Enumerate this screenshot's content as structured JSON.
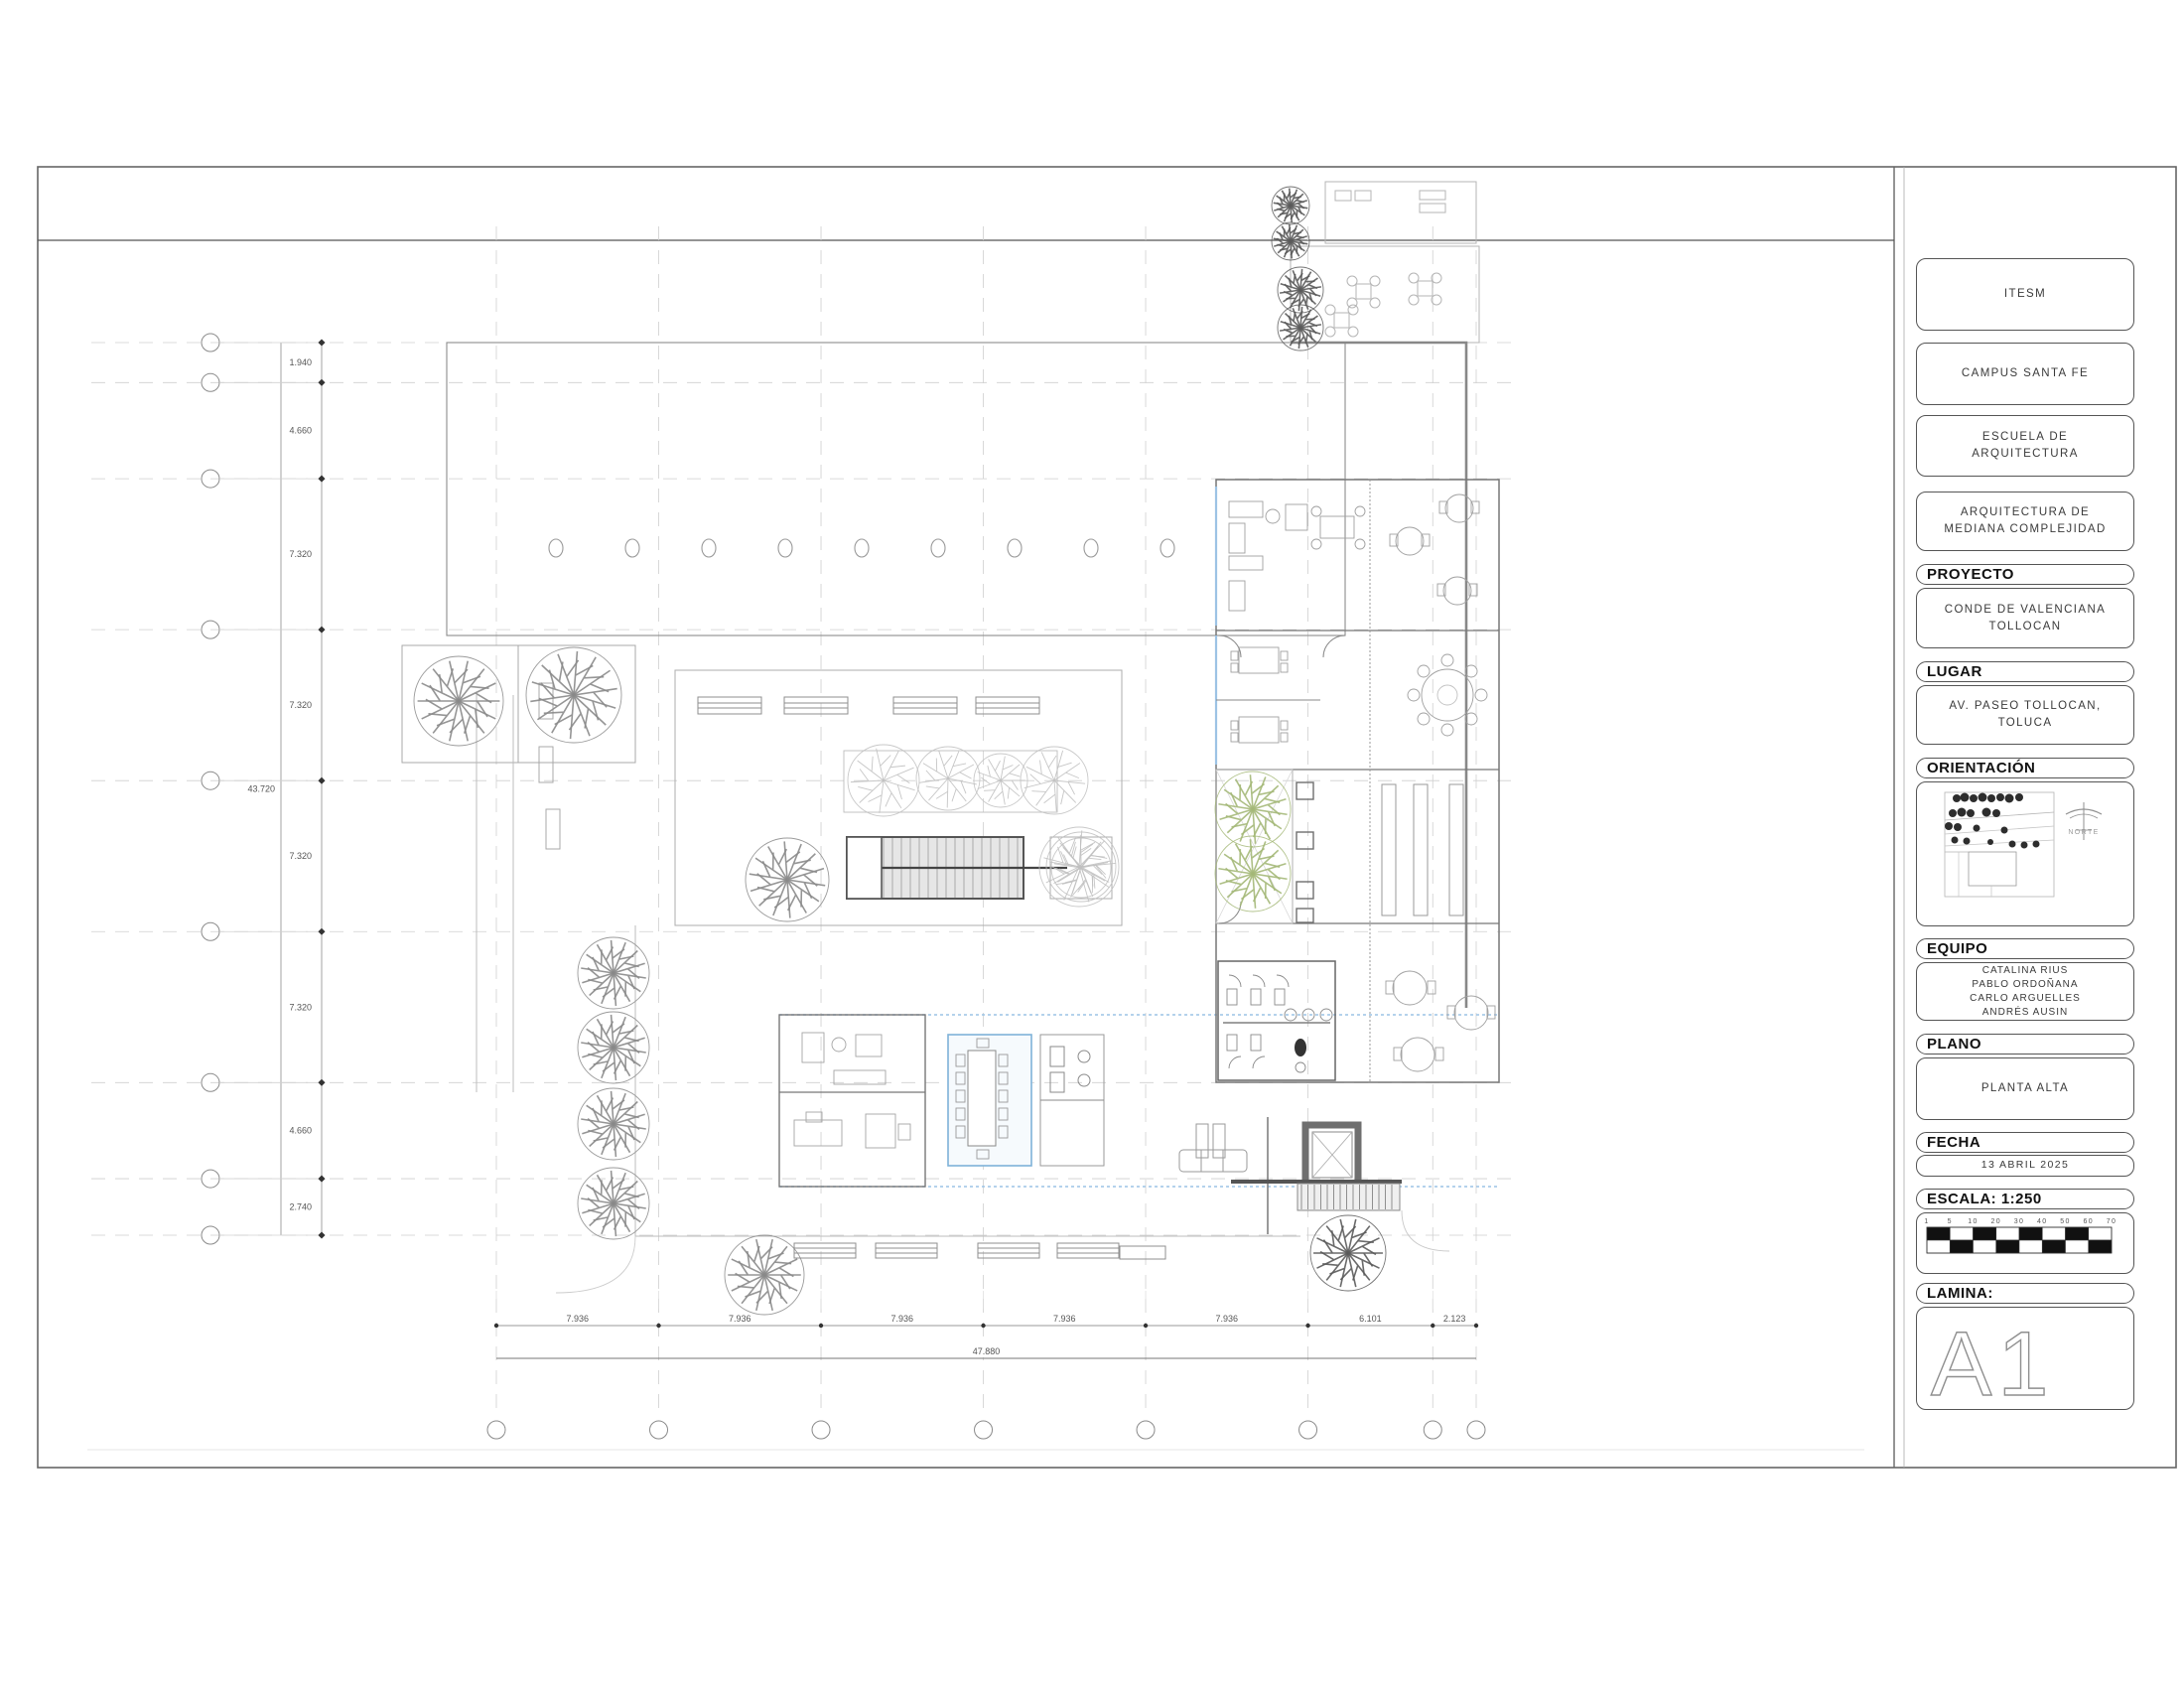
{
  "title_block": {
    "institution": "ITESM",
    "campus": "CAMPUS SANTA FE",
    "school": "ESCUELA DE\nARQUITECTURA",
    "school_l1": "ESCUELA DE",
    "school_l2": "ARQUITECTURA",
    "course_l1": "ARQUITECTURA DE",
    "course_l2": "MEDIANA COMPLEJIDAD",
    "proyecto_label": "PROYECTO",
    "proyecto_l1": "CONDE DE VALENCIANA",
    "proyecto_l2": "TOLLOCAN",
    "lugar_label": "LUGAR",
    "lugar_l1": "AV. PASEO TOLLOCAN,",
    "lugar_l2": "TOLUCA",
    "orientacion_label": "ORIENTACIÓN",
    "norte_label": "NORTE",
    "equipo_label": "EQUIPO",
    "equipo": [
      "CATALINA RIUS",
      "PABLO ORDOÑANA",
      "CARLO ARGUELLES",
      "ANDRÉS AUSIN"
    ],
    "plano_label": "PLANO",
    "plano": "PLANTA ALTA",
    "fecha_label": "FECHA",
    "fecha": "13 ABRIL 2025",
    "escala_label": "ESCALA: 1:250",
    "scale_ticks": [
      "1",
      "5",
      "10",
      "20",
      "30",
      "40",
      "50",
      "60",
      "70"
    ],
    "lamina_label": "LAMINA:",
    "lamina": "A1"
  },
  "dimensions": {
    "left": {
      "segments": [
        "1.940",
        "4.660",
        "7.320",
        "7.320",
        "7.320",
        "7.320",
        "4.660",
        "2.740"
      ],
      "total": "43.720"
    },
    "bottom": {
      "segments": [
        "7.936",
        "7.936",
        "7.936",
        "7.936",
        "7.936",
        "6.101",
        "2.123"
      ],
      "total": "47.880"
    }
  },
  "colors": {
    "wall": "#777777",
    "wall_heavy": "#555555",
    "light_line": "#b9b9b9",
    "grid_dash": "#cfcfcf",
    "blue_accent": "#9cc3e5",
    "green_tree": "#a4b878",
    "tree_gray": "#8a8a8a",
    "hatch_fill": "#e6e6e6",
    "dark": "#2f2f2f"
  }
}
